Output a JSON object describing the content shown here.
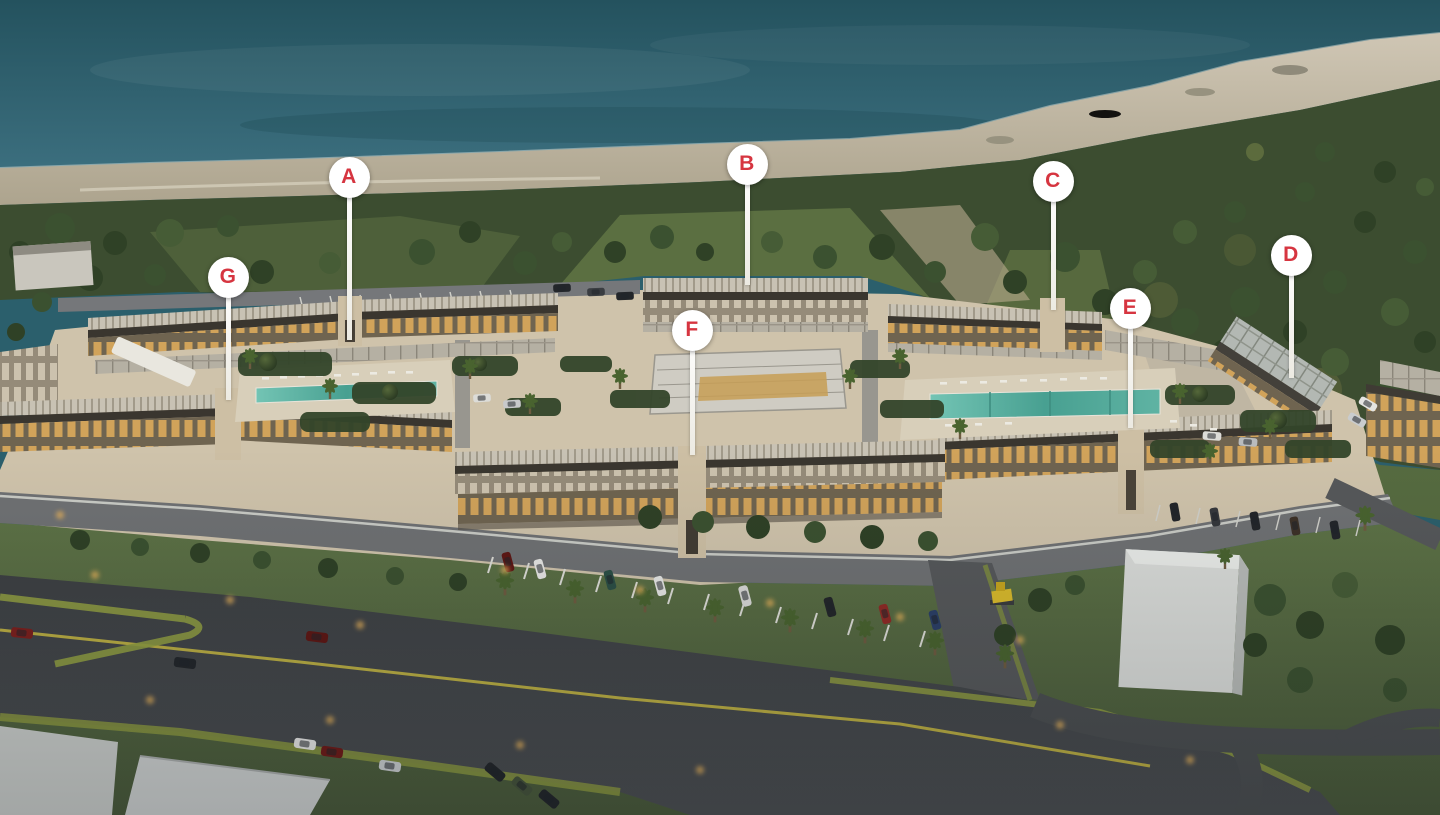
{
  "scene": {
    "colors": {
      "marker_background": "#ffffff",
      "marker_letter": "#d63540",
      "ocean": "#2b5f6c",
      "sand": "#c6bcaa",
      "forest": "#3c4d30",
      "grass": "#5a6f44",
      "courtyard": "#cfc3ab",
      "building_facade": "#c4ae8c",
      "window_glow": "#e2ae5c",
      "pool": "#4fa396",
      "road": "#414447",
      "road_line": "#c7b843",
      "warehouse": "#d9dbd8"
    }
  },
  "markers": [
    {
      "name": "building-marker-a",
      "label": "A",
      "x": 349,
      "y": 177,
      "stem_bottom": 340
    },
    {
      "name": "building-marker-b",
      "label": "B",
      "x": 747,
      "y": 164,
      "stem_bottom": 285
    },
    {
      "name": "building-marker-c",
      "label": "C",
      "x": 1053,
      "y": 181,
      "stem_bottom": 310
    },
    {
      "name": "building-marker-d",
      "label": "D",
      "x": 1291,
      "y": 255,
      "stem_bottom": 378
    },
    {
      "name": "building-marker-e",
      "label": "E",
      "x": 1130,
      "y": 308,
      "stem_bottom": 428
    },
    {
      "name": "building-marker-f",
      "label": "F",
      "x": 692,
      "y": 330,
      "stem_bottom": 455
    },
    {
      "name": "building-marker-g",
      "label": "G",
      "x": 228,
      "y": 277,
      "stem_bottom": 400
    }
  ]
}
